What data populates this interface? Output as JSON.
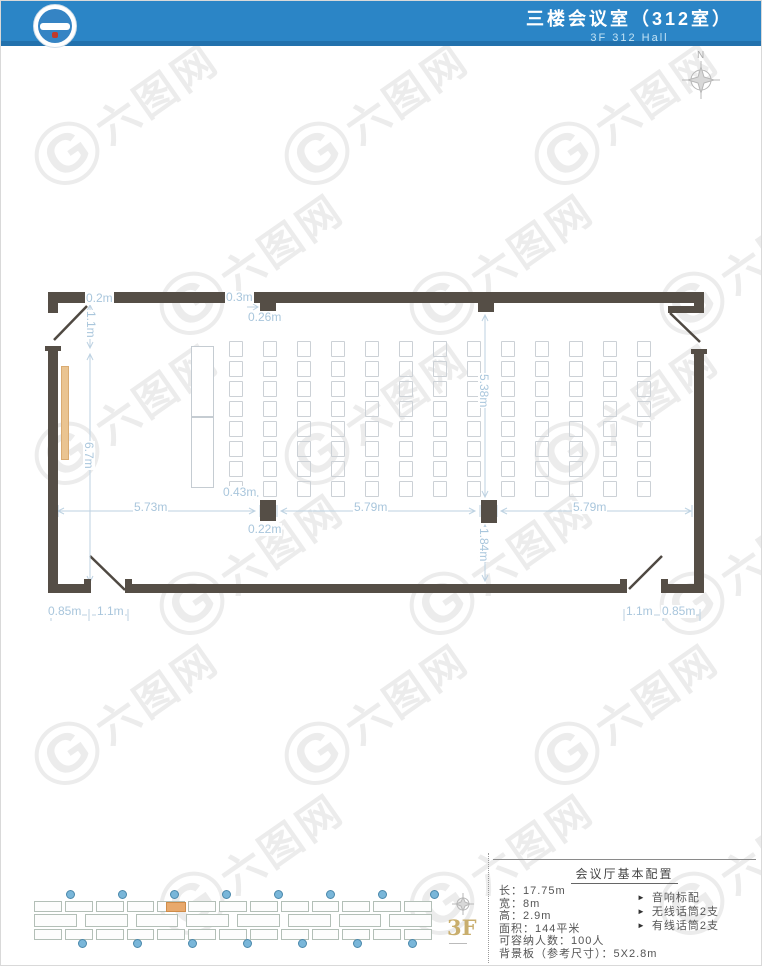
{
  "header": {
    "title": "三楼会议室（312室）",
    "subtitle": "3F 312 Hall"
  },
  "compass": {
    "north_label": "N"
  },
  "plan": {
    "seating": {
      "rows": 8,
      "columns": 13
    },
    "dimension_labels": [
      {
        "text": "0.2m",
        "x": 84,
        "y": 291,
        "vertical": false
      },
      {
        "text": "1.1m",
        "x": 84,
        "y": 309,
        "vertical": true
      },
      {
        "text": "0.3m",
        "x": 224,
        "y": 290,
        "vertical": false
      },
      {
        "text": "0.26m",
        "x": 246,
        "y": 310,
        "vertical": false
      },
      {
        "text": "5.38m",
        "x": 477,
        "y": 372,
        "vertical": true
      },
      {
        "text": "6.7m",
        "x": 82,
        "y": 440,
        "vertical": true
      },
      {
        "text": "5.73m",
        "x": 132,
        "y": 500,
        "vertical": false
      },
      {
        "text": "0.43m",
        "x": 221,
        "y": 485,
        "vertical": false
      },
      {
        "text": "5.79m",
        "x": 352,
        "y": 500,
        "vertical": false
      },
      {
        "text": "0.22m",
        "x": 246,
        "y": 522,
        "vertical": false
      },
      {
        "text": "1.84m",
        "x": 477,
        "y": 526,
        "vertical": true
      },
      {
        "text": "5.79m",
        "x": 571,
        "y": 500,
        "vertical": false
      },
      {
        "text": "0.85m",
        "x": 46,
        "y": 604,
        "vertical": false
      },
      {
        "text": "1.1m",
        "x": 95,
        "y": 604,
        "vertical": false
      },
      {
        "text": "1.1m",
        "x": 624,
        "y": 604,
        "vertical": false
      },
      {
        "text": "0.85m",
        "x": 660,
        "y": 604,
        "vertical": false
      }
    ]
  },
  "info_panel": {
    "title": "会议厅基本配置",
    "specs": [
      {
        "label": "长",
        "value": "17.75m"
      },
      {
        "label": "宽",
        "value": "8m"
      },
      {
        "label": "高",
        "value": "2.9m"
      },
      {
        "label": "面积",
        "value": "144平米"
      },
      {
        "label": "可容纳人数",
        "value": "100人"
      },
      {
        "label": "背景板（参考尺寸）",
        "value": "5X2.8m"
      }
    ],
    "bullet_glyph": "►",
    "equipment": [
      "音响标配",
      "无线话筒2支",
      "有线话筒2支"
    ]
  },
  "mini_plan": {
    "floor_label": "3F",
    "top_rooms": 13,
    "middle_rooms": 8,
    "bottom_rooms": 13,
    "top_markers": 8,
    "bottom_markers": 7
  },
  "watermark": {
    "logo_letter": "G",
    "text": "六图网"
  },
  "colors": {
    "header_blue": "#2b85c6",
    "wall": "#554e46",
    "dimension_text": "#a9c6dc",
    "board_tan": "#eac491",
    "mini_marker_blue": "#79b6d9",
    "mini_highlight_orange": "#e8a96c",
    "floor_label_gold": "#c9ae6d"
  }
}
